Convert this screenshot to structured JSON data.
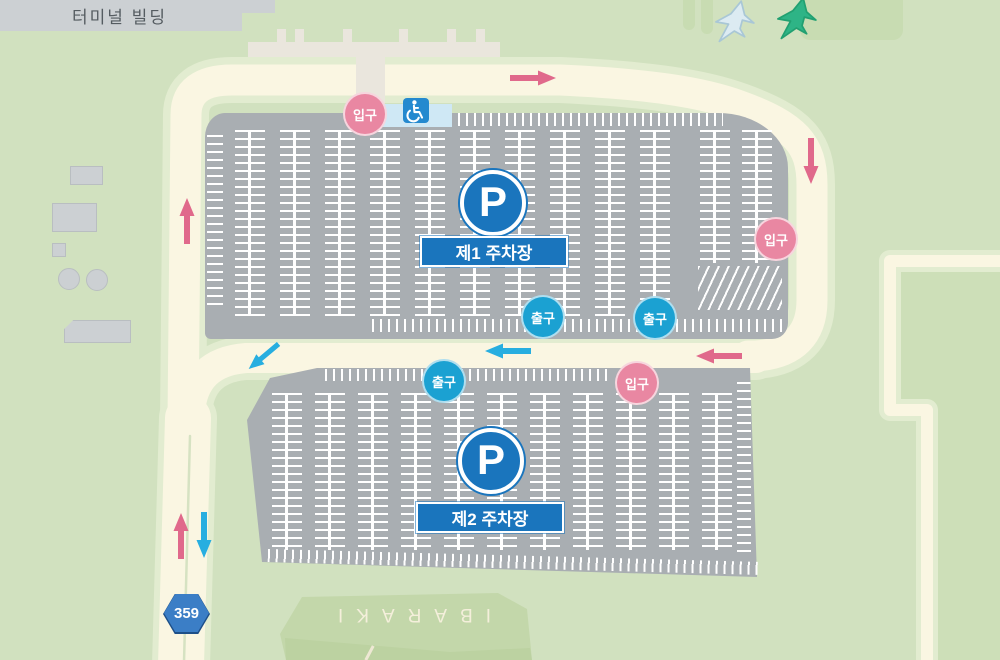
{
  "map": {
    "terminal_label": "터미널 빌딩",
    "lots": [
      {
        "p_symbol": "P",
        "label": "제1 주차장"
      },
      {
        "p_symbol": "P",
        "label": "제2 주차장"
      }
    ],
    "markers": {
      "entrance_label": "입구",
      "exit_label": "출구"
    },
    "route_badge": "359",
    "ground_label": "IBARAKI",
    "icons": {
      "wheelchair": "wheelchair-accessibility-symbol",
      "airplane_light": "airplane-silhouette",
      "airplane_green": "airplane-silhouette"
    },
    "arrows": [
      {
        "name": "top-road-arrow",
        "direction": "right",
        "color": "pink"
      },
      {
        "name": "right-road-arrow",
        "direction": "down",
        "color": "pink"
      },
      {
        "name": "left-road-arrow",
        "direction": "up",
        "color": "pink"
      },
      {
        "name": "middle-road-arrow-pink",
        "direction": "left",
        "color": "pink"
      },
      {
        "name": "middle-road-arrow-blue",
        "direction": "left",
        "color": "blue"
      },
      {
        "name": "junction-arrow-blue",
        "direction": "down-left",
        "color": "blue"
      },
      {
        "name": "route359-arrow-up",
        "direction": "up",
        "color": "pink"
      },
      {
        "name": "route359-arrow-down",
        "direction": "down",
        "color": "blue"
      }
    ],
    "colors": {
      "bg": "#d1e1bf",
      "field": "#cddfb8",
      "apron": "#c8dcb2",
      "road": "#faf6e2",
      "verge": "#e2ecd0",
      "centerline": "#d6e2c2",
      "lot": "#a9aeb2",
      "marking": "#ffffff",
      "building": "#ccd0d3",
      "building-stroke": "#b9bec1",
      "walkway": "#eae6dd",
      "terminal-text": "#555c61",
      "pink": "#e987a2",
      "pink-arrow": "#e0698b",
      "blue": "#1ba1d2",
      "blue-arrow": "#27aee0",
      "p-blue": "#1a75bd",
      "strip": "#cfe8f5",
      "wc": "#2489cf",
      "badge": "#3b7ec6",
      "badge-edge": "#1d4f88",
      "ground": "#c3d7aa",
      "ground-shade": "#bcd2a1",
      "ground-text": "#f4efdb",
      "plane-light": "#dcebf2",
      "plane-light-stroke": "#a9c7d6",
      "plane-green": "#2eb486",
      "plane-green-stroke": "#21a071"
    }
  }
}
